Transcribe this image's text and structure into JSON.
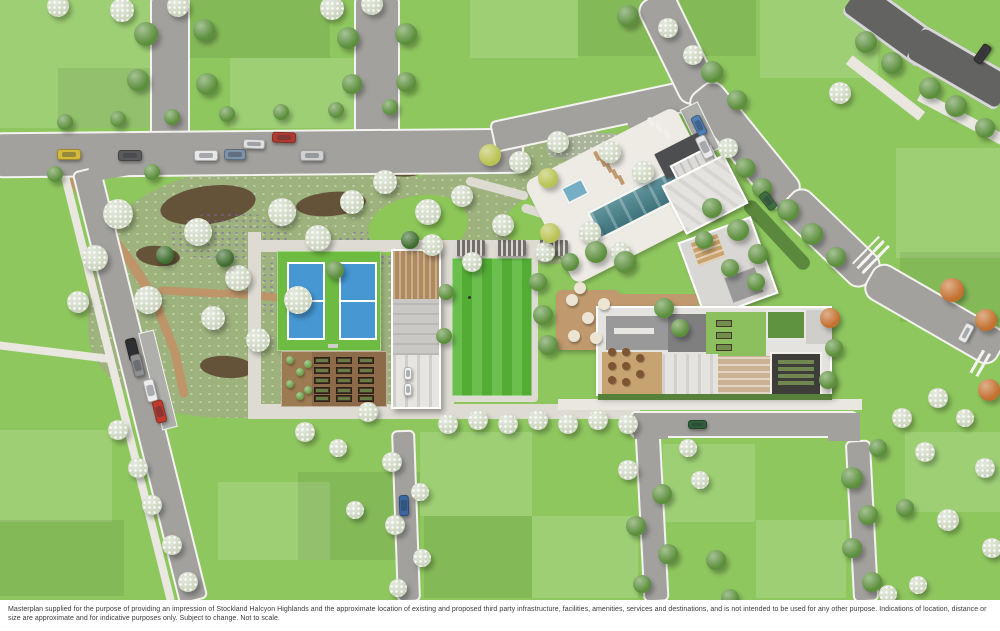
{
  "footer": {
    "disclaimer": "Masterplan supplied for the purpose of providing an impression of Stockland Halcyon Highlands and the approximate location of existing and proposed third party infrastructure, facilities, amenities, services and destinations, and is not intended to be used for any other purpose. Indications of location, distance or size are approximate and for indicative purposes only. Subject to change. Not to scale."
  },
  "colors": {
    "grass_base": "#8fc75f",
    "grass_bright": "#8cc758",
    "patch_light": "rgba(255,255,255,0.14)",
    "patch_dark": "rgba(0,0,0,0.07)",
    "road": "#a2a19e",
    "road_dark": "#636362",
    "curb": "#f4f3ef",
    "path": "#dedbd2",
    "sidewalk": "#e9e7e0",
    "garden_base": "#9db27c",
    "mulch": "#5f4a33",
    "garden_path": "#bf9468",
    "court_surround": "#6dbb41",
    "court_blue": "#4697d2",
    "court_line": "#ffffff",
    "bowling_green": "#57b637",
    "soil": "#8d6a48",
    "bed_dark": "#46362a",
    "bed_green": "#6f8f4a",
    "pool_water": "#44808a",
    "pool_deck": "#edebe4",
    "spa": "#76aec6",
    "deck_wood": "#c09a6e",
    "dining_floor": "#c8a372",
    "table_wood": "#7c5633",
    "umbrella": "#ece5d4",
    "roof_white": "#e4e3df",
    "roof_light": "#cfcecb",
    "roof_gray": "#9a999a",
    "roof_mid": "#7f7f80",
    "roof_dark": "#4d4e4f",
    "roof_green": "#5f9340",
    "cinema": "#3f3d3a",
    "seat_green": "#72864f",
    "tree_dark": "#3f6d2e",
    "tree_mid": "#5c8f3c",
    "tree_light": "#7fae55",
    "blossom": "#ccd5bf",
    "tree_yellow": "#b9c353",
    "tree_orange": "#c4702f",
    "bush": "#6da04c",
    "hedge": "#55813a",
    "footer_bg": "#ffffff",
    "footer_text": "#3a3a3a"
  },
  "scene": {
    "trees": [
      [
        "b",
        58,
        6,
        11
      ],
      [
        "b",
        122,
        10,
        12
      ],
      [
        "b",
        178,
        6,
        11
      ],
      [
        "m",
        146,
        34,
        12
      ],
      [
        "m",
        204,
        30,
        11
      ],
      [
        "m",
        138,
        80,
        11
      ],
      [
        "m",
        207,
        84,
        11
      ],
      [
        "b",
        332,
        8,
        12
      ],
      [
        "b",
        372,
        4,
        11
      ],
      [
        "m",
        348,
        38,
        11
      ],
      [
        "m",
        406,
        34,
        11
      ],
      [
        "m",
        352,
        84,
        10
      ],
      [
        "m",
        406,
        82,
        10
      ],
      [
        "m",
        65,
        122,
        8
      ],
      [
        "m",
        118,
        119,
        8
      ],
      [
        "m",
        172,
        117,
        8
      ],
      [
        "m",
        227,
        114,
        8
      ],
      [
        "m",
        281,
        112,
        8
      ],
      [
        "m",
        336,
        110,
        8
      ],
      [
        "m",
        390,
        107,
        8
      ],
      [
        "m",
        152,
        172,
        8
      ],
      [
        "m",
        55,
        174,
        8
      ],
      [
        "m",
        628,
        16,
        11
      ],
      [
        "b",
        668,
        28,
        10
      ],
      [
        "b",
        693,
        55,
        10
      ],
      [
        "m",
        712,
        72,
        11
      ],
      [
        "m",
        737,
        100,
        10
      ],
      [
        "m",
        866,
        42,
        11
      ],
      [
        "m",
        892,
        63,
        11
      ],
      [
        "m",
        930,
        88,
        11
      ],
      [
        "m",
        956,
        106,
        11
      ],
      [
        "m",
        985,
        128,
        10
      ],
      [
        "b",
        840,
        93,
        11
      ],
      [
        "b",
        728,
        148,
        10
      ],
      [
        "m",
        745,
        168,
        10
      ],
      [
        "m",
        762,
        188,
        10
      ],
      [
        "m",
        788,
        210,
        11
      ],
      [
        "m",
        812,
        234,
        11
      ],
      [
        "m",
        836,
        257,
        10
      ],
      [
        "o",
        952,
        290,
        12
      ],
      [
        "o",
        986,
        320,
        11
      ],
      [
        "o",
        989,
        390,
        11
      ],
      [
        "o",
        830,
        318,
        10
      ],
      [
        "b",
        118,
        214,
        15
      ],
      [
        "b",
        95,
        258,
        13
      ],
      [
        "b",
        148,
        300,
        14
      ],
      [
        "b",
        198,
        232,
        14
      ],
      [
        "b",
        238,
        278,
        13
      ],
      [
        "b",
        213,
        318,
        12
      ],
      [
        "b",
        282,
        212,
        14
      ],
      [
        "b",
        318,
        238,
        13
      ],
      [
        "b",
        352,
        202,
        12
      ],
      [
        "b",
        298,
        300,
        14
      ],
      [
        "b",
        258,
        340,
        12
      ],
      [
        "b",
        385,
        182,
        12
      ],
      [
        "b",
        428,
        212,
        13
      ],
      [
        "b",
        462,
        196,
        11
      ],
      [
        "b",
        520,
        162,
        11
      ],
      [
        "b",
        558,
        142,
        11
      ],
      [
        "b",
        610,
        152,
        11
      ],
      [
        "b",
        643,
        172,
        11
      ],
      [
        "b",
        590,
        232,
        11
      ],
      [
        "b",
        620,
        252,
        10
      ],
      [
        "b",
        545,
        252,
        10
      ],
      [
        "b",
        503,
        225,
        11
      ],
      [
        "b",
        472,
        262,
        10
      ],
      [
        "b",
        432,
        245,
        11
      ],
      [
        "y",
        490,
        155,
        11
      ],
      [
        "y",
        548,
        178,
        10
      ],
      [
        "y",
        550,
        233,
        10
      ],
      [
        "d",
        165,
        255,
        9
      ],
      [
        "d",
        225,
        258,
        9
      ],
      [
        "m",
        335,
        270,
        9
      ],
      [
        "d",
        410,
        240,
        9
      ],
      [
        "m",
        543,
        315,
        10
      ],
      [
        "m",
        548,
        345,
        10
      ],
      [
        "m",
        538,
        282,
        9
      ],
      [
        "m",
        596,
        252,
        11
      ],
      [
        "m",
        625,
        262,
        11
      ],
      [
        "m",
        570,
        262,
        9
      ],
      [
        "m",
        664,
        308,
        10
      ],
      [
        "m",
        680,
        328,
        9
      ],
      [
        "m",
        712,
        208,
        10
      ],
      [
        "m",
        738,
        230,
        11
      ],
      [
        "m",
        758,
        254,
        10
      ],
      [
        "m",
        730,
        268,
        9
      ],
      [
        "m",
        704,
        240,
        9
      ],
      [
        "m",
        756,
        282,
        9
      ],
      [
        "m",
        834,
        348,
        9
      ],
      [
        "m",
        828,
        380,
        9
      ],
      [
        "b",
        448,
        424,
        10
      ],
      [
        "b",
        478,
        420,
        10
      ],
      [
        "b",
        508,
        424,
        10
      ],
      [
        "b",
        538,
        420,
        10
      ],
      [
        "b",
        568,
        424,
        10
      ],
      [
        "b",
        598,
        420,
        10
      ],
      [
        "b",
        628,
        424,
        10
      ],
      [
        "b",
        368,
        412,
        10
      ],
      [
        "b",
        305,
        432,
        10
      ],
      [
        "b",
        338,
        448,
        9
      ],
      [
        "b",
        78,
        302,
        11
      ],
      [
        "b",
        118,
        430,
        10
      ],
      [
        "b",
        138,
        468,
        10
      ],
      [
        "b",
        152,
        505,
        10
      ],
      [
        "b",
        172,
        545,
        10
      ],
      [
        "b",
        188,
        582,
        10
      ],
      [
        "b",
        392,
        462,
        10
      ],
      [
        "b",
        420,
        492,
        9
      ],
      [
        "b",
        395,
        525,
        10
      ],
      [
        "b",
        422,
        558,
        9
      ],
      [
        "b",
        398,
        588,
        9
      ],
      [
        "b",
        355,
        510,
        9
      ],
      [
        "b",
        628,
        470,
        10
      ],
      [
        "b",
        700,
        480,
        9
      ],
      [
        "m",
        662,
        494,
        10
      ],
      [
        "m",
        636,
        526,
        10
      ],
      [
        "m",
        668,
        554,
        10
      ],
      [
        "m",
        642,
        584,
        9
      ],
      [
        "m",
        716,
        560,
        10
      ],
      [
        "m",
        730,
        598,
        9
      ],
      [
        "b",
        688,
        448,
        9
      ],
      [
        "m",
        852,
        478,
        11
      ],
      [
        "m",
        868,
        515,
        10
      ],
      [
        "m",
        852,
        548,
        10
      ],
      [
        "m",
        872,
        582,
        10
      ],
      [
        "b",
        888,
        594,
        9
      ],
      [
        "b",
        902,
        418,
        10
      ],
      [
        "b",
        938,
        398,
        10
      ],
      [
        "b",
        965,
        418,
        9
      ],
      [
        "b",
        925,
        452,
        10
      ],
      [
        "b",
        985,
        468,
        10
      ],
      [
        "b",
        948,
        520,
        11
      ],
      [
        "b",
        992,
        548,
        10
      ],
      [
        "b",
        918,
        585,
        9
      ],
      [
        "m",
        878,
        448,
        9
      ],
      [
        "m",
        905,
        508,
        9
      ],
      [
        "u",
        290,
        360,
        4
      ],
      [
        "u",
        300,
        372,
        4
      ],
      [
        "u",
        290,
        384,
        4
      ],
      [
        "u",
        300,
        396,
        4
      ],
      [
        "u",
        308,
        364,
        4
      ],
      [
        "u",
        308,
        390,
        4
      ],
      [
        "m",
        446,
        292,
        8
      ],
      [
        "m",
        444,
        336,
        8
      ]
    ],
    "cars": [
      [
        57,
        149,
        24,
        11,
        0,
        "#d3b93c"
      ],
      [
        118,
        150,
        24,
        11,
        0,
        "#5b5b5b"
      ],
      [
        194,
        150,
        24,
        11,
        0,
        "#e8e8e8"
      ],
      [
        224,
        149,
        22,
        11,
        0,
        "#7e93a8"
      ],
      [
        300,
        150,
        24,
        11,
        0,
        "#d0d0d0"
      ],
      [
        272,
        132,
        24,
        11,
        2,
        "#b23b30"
      ],
      [
        243,
        139,
        22,
        10,
        2,
        "#dedede"
      ],
      [
        127,
        338,
        11,
        23,
        -14,
        "#2f2f2f"
      ],
      [
        132,
        354,
        11,
        23,
        -14,
        "#909090"
      ],
      [
        145,
        379,
        11,
        23,
        -14,
        "#ededed"
      ],
      [
        154,
        400,
        11,
        23,
        -14,
        "#c03a2f"
      ],
      [
        399,
        495,
        10,
        21,
        -2,
        "#3b66a0"
      ],
      [
        694,
        115,
        10,
        21,
        -26,
        "#4f7fb5"
      ],
      [
        699,
        135,
        11,
        24,
        -26,
        "#e9e9e9"
      ],
      [
        763,
        191,
        10,
        20,
        -38,
        "#3f6f3f"
      ],
      [
        972,
        49,
        21,
        10,
        -55,
        "#3a3a3a"
      ],
      [
        956,
        328,
        20,
        10,
        -62,
        "#eaeaea"
      ],
      [
        688,
        420,
        19,
        9,
        0,
        "#2f5d3a"
      ],
      [
        404,
        367,
        8,
        13,
        0,
        "#f2f2f2"
      ],
      [
        404,
        383,
        8,
        13,
        0,
        "#f2f2f2"
      ]
    ],
    "lawn_patches": [
      [
        0,
        0,
        150,
        128,
        "l"
      ],
      [
        230,
        58,
        126,
        70,
        "l"
      ],
      [
        470,
        0,
        108,
        58,
        "l"
      ],
      [
        760,
        0,
        118,
        78,
        "l"
      ],
      [
        896,
        148,
        104,
        110,
        "l"
      ],
      [
        663,
        444,
        92,
        78,
        "l"
      ],
      [
        756,
        520,
        90,
        78,
        "l"
      ],
      [
        420,
        432,
        112,
        84,
        "l"
      ],
      [
        532,
        516,
        106,
        82,
        "l"
      ],
      [
        218,
        482,
        112,
        78,
        "l"
      ],
      [
        0,
        430,
        112,
        92,
        "l"
      ],
      [
        905,
        432,
        95,
        80,
        "l"
      ],
      [
        188,
        0,
        142,
        58,
        "d"
      ],
      [
        58,
        68,
        130,
        60,
        "d"
      ],
      [
        578,
        0,
        94,
        56,
        "d"
      ],
      [
        298,
        472,
        122,
        88,
        "d"
      ],
      [
        0,
        520,
        124,
        76,
        "d"
      ],
      [
        900,
        252,
        100,
        70,
        "d"
      ],
      [
        424,
        516,
        108,
        82,
        "d"
      ],
      [
        680,
        0,
        76,
        56,
        "d"
      ]
    ],
    "planter_beds": [
      [
        314,
        357
      ],
      [
        314,
        367
      ],
      [
        314,
        377
      ],
      [
        314,
        387
      ],
      [
        314,
        395
      ],
      [
        336,
        357
      ],
      [
        336,
        367
      ],
      [
        336,
        377
      ],
      [
        336,
        387
      ],
      [
        336,
        395
      ],
      [
        358,
        357
      ],
      [
        358,
        367
      ],
      [
        358,
        377
      ],
      [
        358,
        387
      ],
      [
        358,
        395
      ]
    ],
    "deck_tables": [
      [
        572,
        300
      ],
      [
        588,
        318
      ],
      [
        574,
        336
      ],
      [
        604,
        304
      ],
      [
        596,
        338
      ],
      [
        580,
        288
      ]
    ],
    "dining_tables": [
      [
        612,
        352
      ],
      [
        626,
        352
      ],
      [
        612,
        366
      ],
      [
        626,
        366
      ],
      [
        612,
        380
      ],
      [
        640,
        358
      ],
      [
        640,
        374
      ],
      [
        626,
        382
      ]
    ],
    "loungers": [
      [
        598,
        160
      ],
      [
        604,
        166
      ],
      [
        610,
        172
      ],
      [
        616,
        178
      ],
      [
        592,
        154
      ]
    ],
    "wloungers": [
      [
        646,
        120
      ],
      [
        654,
        126
      ],
      [
        662,
        132
      ]
    ]
  }
}
